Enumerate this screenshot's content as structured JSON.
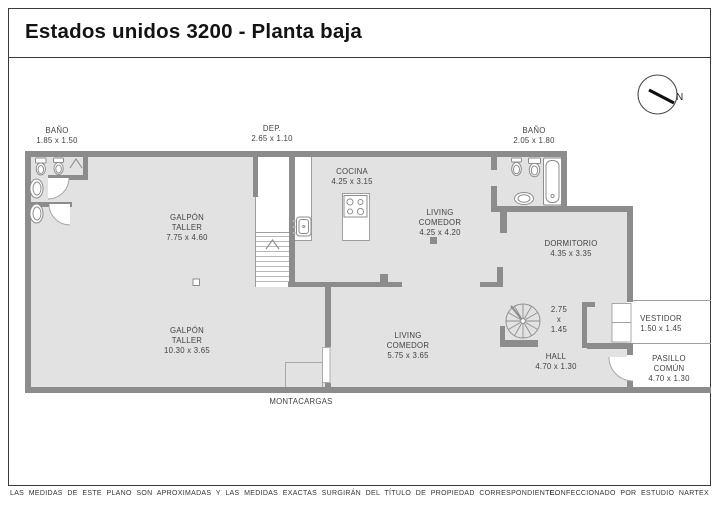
{
  "header": {
    "title": "Estados unidos 3200 - Planta baja"
  },
  "compass": {
    "label": "N"
  },
  "plan": {
    "outside_labels": {
      "bano_left": {
        "name": "BAÑO",
        "dims": "1.85 x 1.50"
      },
      "dep": {
        "name": "DEP.",
        "dims": "2.65 x 1.10"
      },
      "bano_right": {
        "name": "BAÑO",
        "dims": "2.05 x 1.80"
      },
      "montacargas": {
        "name": "MONTACARGAS"
      }
    },
    "rooms": {
      "galpon_taller_1": {
        "line1": "GALPÓN",
        "line2": "TALLER",
        "dims": "7.75 x 4.60"
      },
      "cocina": {
        "line1": "COCINA",
        "dims": "4.25 x 3.15"
      },
      "living_comedor_1": {
        "line1": "LIVING",
        "line2": "COMEDOR",
        "dims": "4.25 x 4.20"
      },
      "dormitorio": {
        "line1": "DORMITORIO",
        "dims": "4.35 x 3.35"
      },
      "galpon_taller_2": {
        "line1": "GALPÓN",
        "line2": "TALLER",
        "dims": "10.30 x 3.65"
      },
      "living_comedor_2": {
        "line1": "LIVING",
        "line2": "COMEDOR",
        "dims": "5.75 x 3.65"
      },
      "escalera_caracol": {
        "line1": "2.75",
        "line2": "x",
        "dims": "1.45"
      },
      "vestidor": {
        "line1": "VESTIDOR",
        "dims": "1.50 x 1.45"
      },
      "pasillo_comun": {
        "line1": "PASILLO",
        "line2": "COMÚN",
        "dims": "4.70 x 1.30"
      },
      "hall": {
        "line1": "HALL",
        "dims": "4.70 x 1.30"
      }
    }
  },
  "footer": {
    "disclaimer": "LAS MEDIDAS DE ESTE PLANO SON APROXIMADAS Y LAS MEDIDAS EXACTAS SURGIRÁN DEL TÍTULO DE PROPIEDAD CORRESPONDIENTE.",
    "credit": "CONFECCIONADO POR ESTUDIO NARTEX"
  },
  "colors": {
    "wall": "#8c8c8c",
    "floor": "#e2e2e2",
    "line": "#9e9e9e"
  }
}
